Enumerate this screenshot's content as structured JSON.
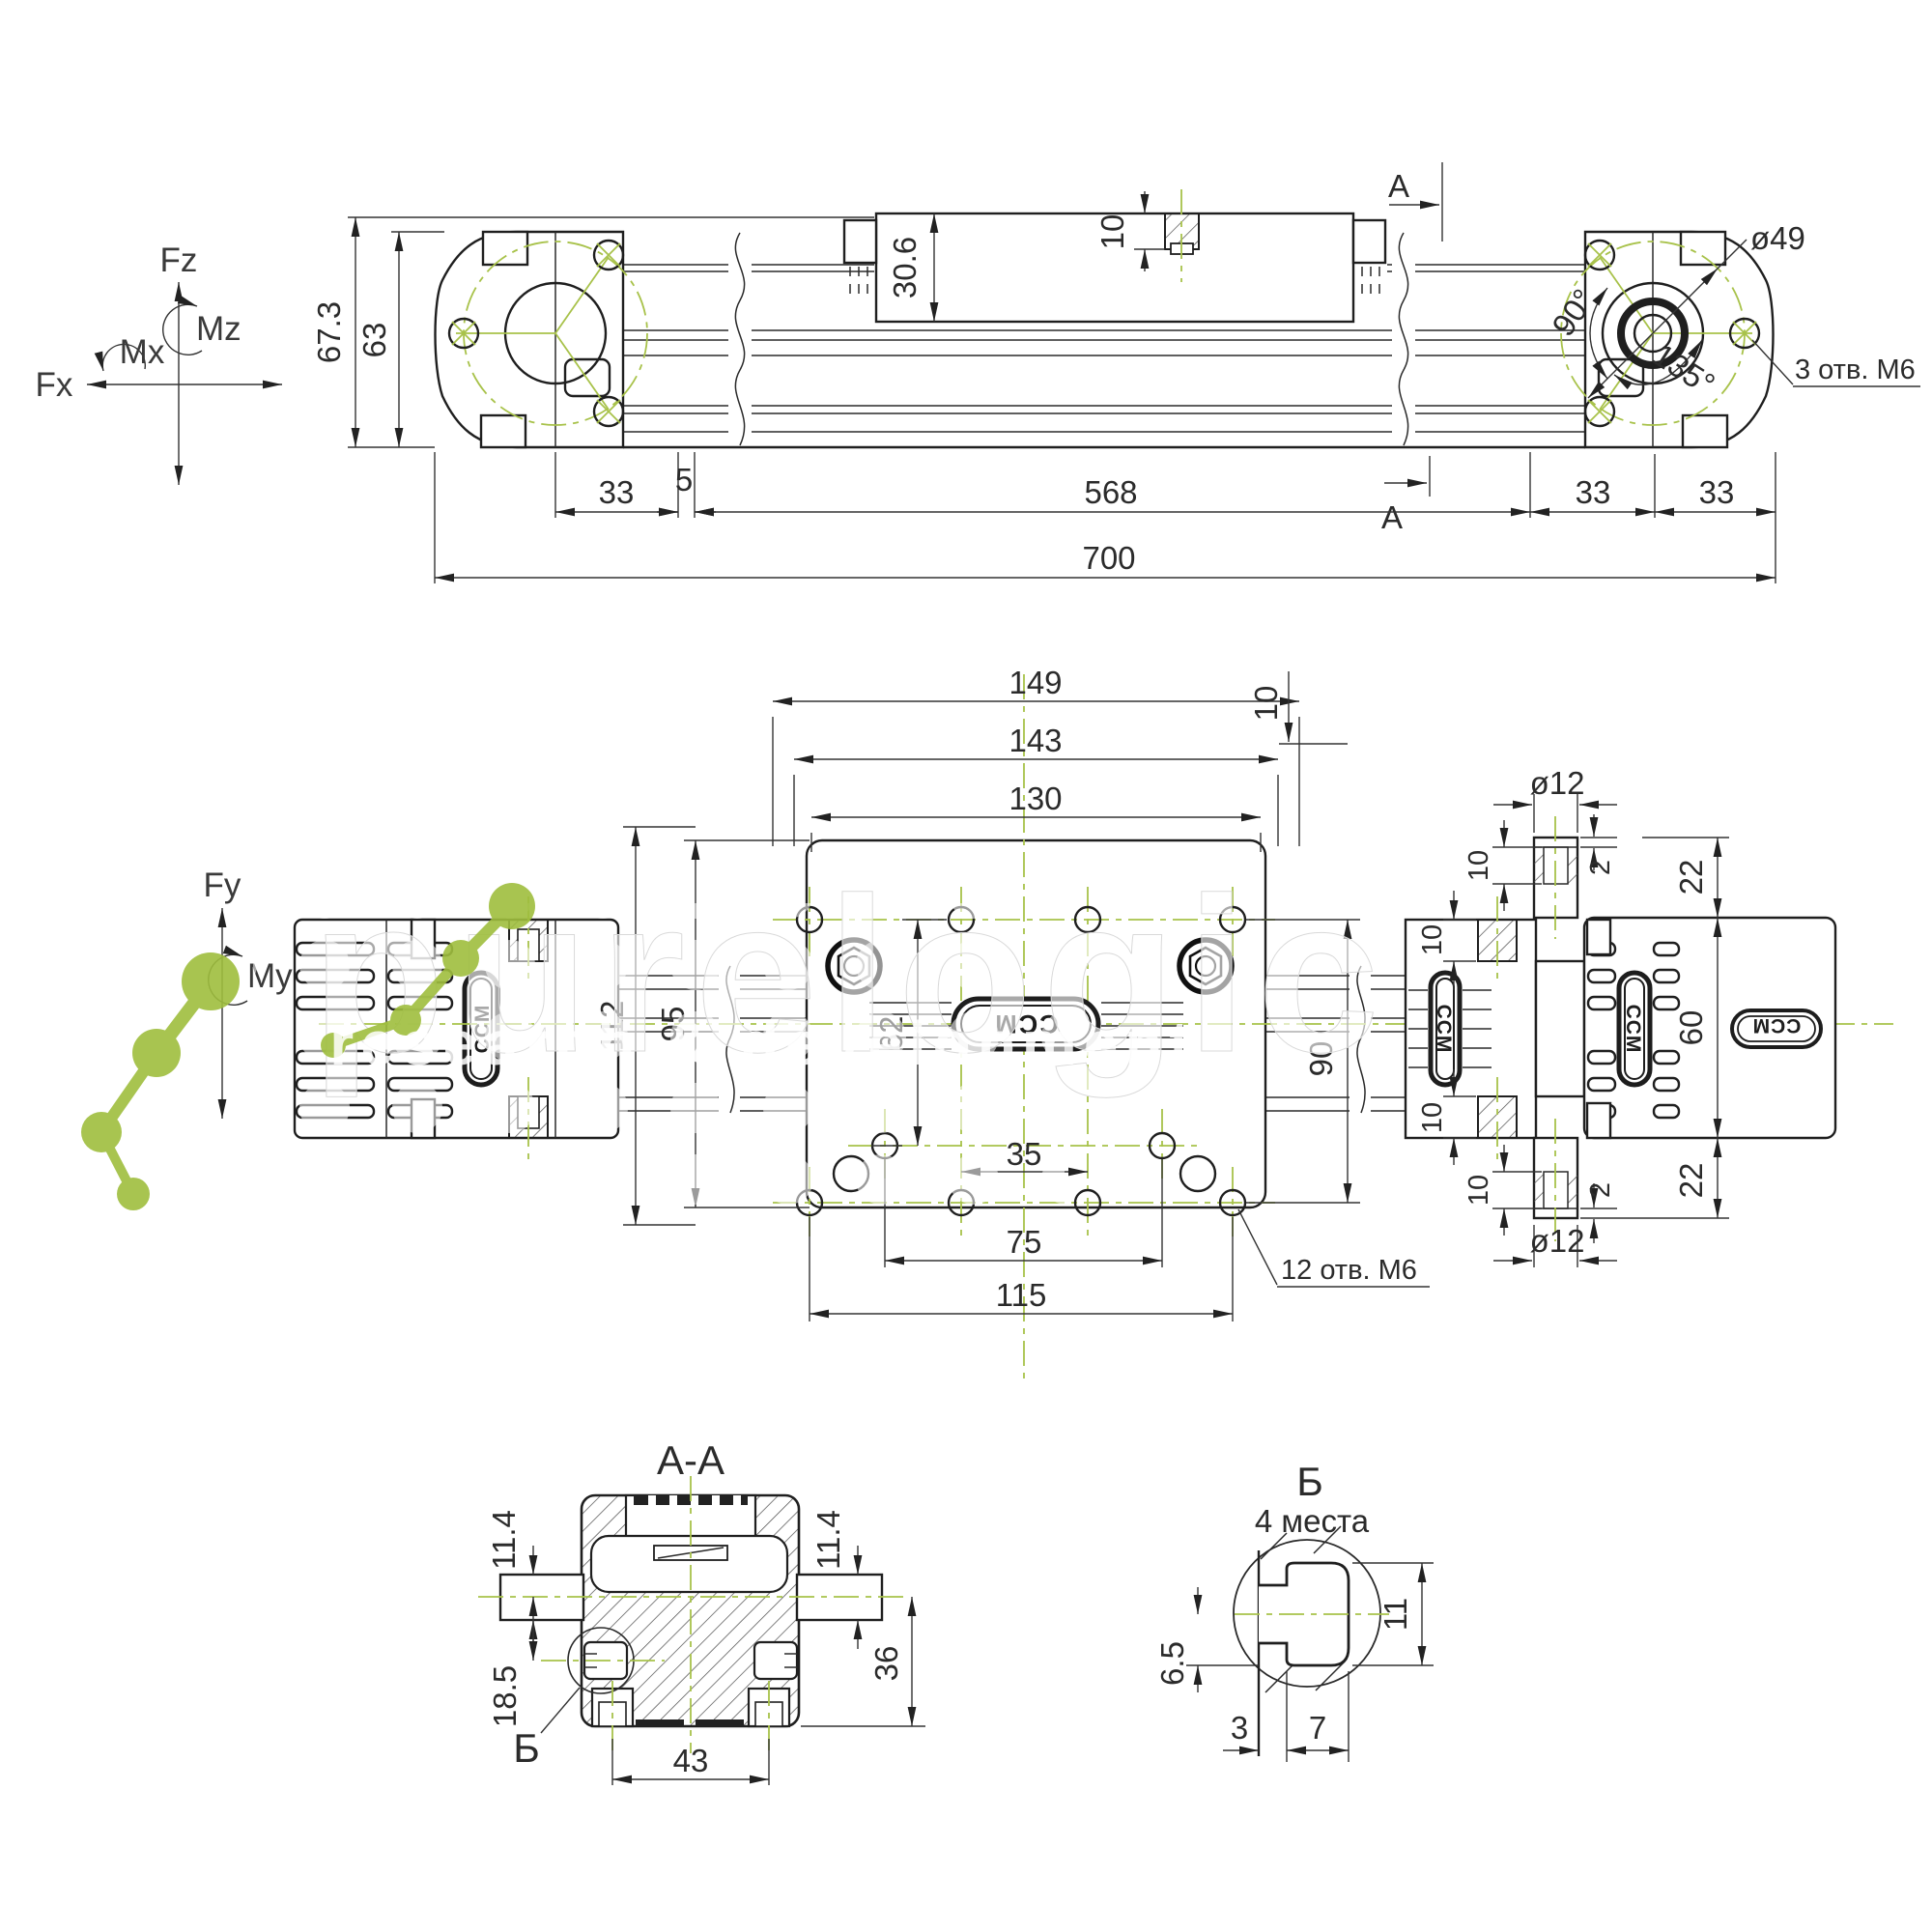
{
  "axes": {
    "fz": "Fz",
    "mz": "Mz",
    "mx": "Mx",
    "fx": "Fx",
    "fy": "Fy",
    "my": "My"
  },
  "watermark": {
    "brand": "purelogic",
    "tagline": "research & development"
  },
  "logo": "CCM",
  "side_view": {
    "height_total": "67.3",
    "height_body": "63",
    "carriage_height": "30.6",
    "hole_depth": "10",
    "section_top": "A",
    "section_bottom": "A",
    "dim_33_left": "33",
    "dim_5": "5",
    "dim_568": "568",
    "dim_33_mid": "33",
    "dim_33_right": "33",
    "dim_700": "700",
    "bolt_circle": "ø49",
    "angle_90": "90°",
    "angle_135": "135°",
    "note_holes": "3 отв. M6"
  },
  "plan_view": {
    "dim_149": "149",
    "dim_143": "143",
    "dim_130": "130",
    "dim_112": "112",
    "dim_95": "95",
    "dim_62": "62",
    "dim_90": "90",
    "dim_35": "35",
    "dim_75": "75",
    "dim_115": "115",
    "note_holes": "12 отв. M6",
    "port_dia_top": "ø12",
    "port_dia_bottom": "ø12",
    "dim_10_plate": "10",
    "dim_10_a": "10",
    "dim_10_b": "10",
    "dim_2_top": "2",
    "dim_22_top": "22",
    "dim_60": "60",
    "dim_22_bottom": "22",
    "dim_2_bottom": "2",
    "dim_10_c": "10",
    "dim_10_d": "10"
  },
  "section_aa": {
    "title": "A-A",
    "dim_11_4_left": "11.4",
    "dim_11_4_right": "11.4",
    "dim_18_5": "18.5",
    "dim_36": "36",
    "dim_43": "43",
    "detail_ref": "Б"
  },
  "detail_b": {
    "title": "Б",
    "subtitle": "4 места",
    "dim_11": "11",
    "dim_6_5": "6.5",
    "dim_3": "3",
    "dim_7": "7"
  }
}
